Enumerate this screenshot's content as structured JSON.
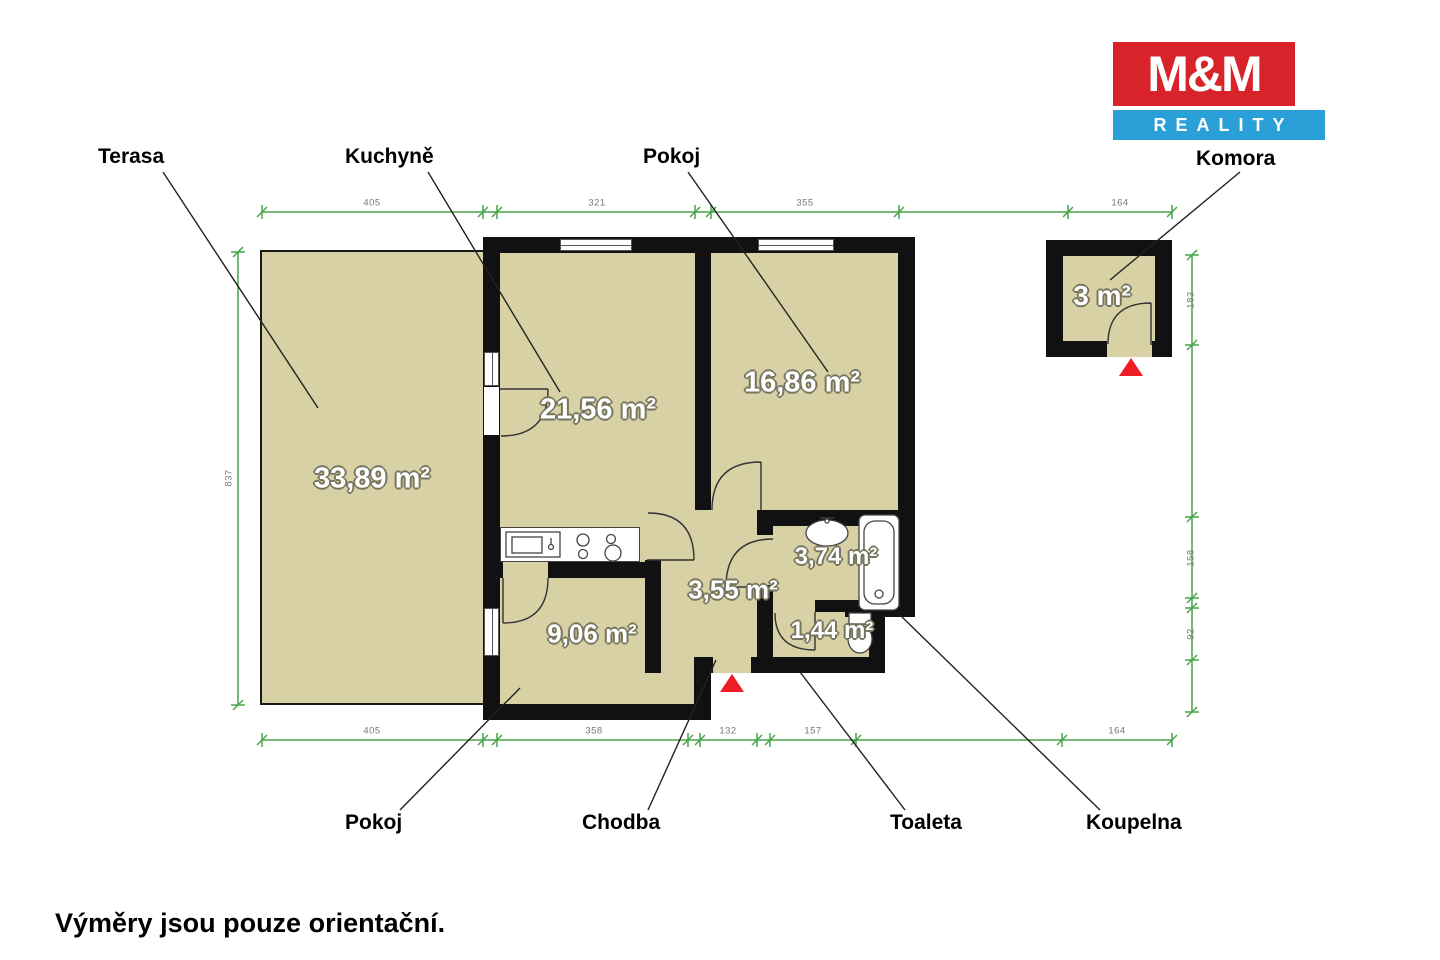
{
  "brand": {
    "line1": "M&M",
    "line2": "REALITY"
  },
  "callouts": {
    "terasa": "Terasa",
    "kuchyne": "Kuchyně",
    "pokoj_top": "Pokoj",
    "komora": "Komora",
    "pokoj_bottom": "Pokoj",
    "chodba": "Chodba",
    "toaleta": "Toaleta",
    "koupelna": "Koupelna"
  },
  "areas": {
    "terasa": "33,89 m²",
    "kuchyne": "21,56 m²",
    "pokoj_top": "16,86 m²",
    "komora": "3 m²",
    "pokoj_bottom": "9,06 m²",
    "chodba": "3,55 m²",
    "koupelna": "3,74 m²",
    "toaleta": "1,44 m²"
  },
  "dims": {
    "top": [
      "405",
      "321",
      "355",
      "164"
    ],
    "bottom": [
      "405",
      "358",
      "132",
      "157",
      "164"
    ],
    "left": [
      "837"
    ],
    "right": [
      "183",
      "158",
      "92"
    ]
  },
  "footer": {
    "note": "Výměry jsou pouze orientační."
  },
  "colors": {
    "floor": "#d8d1a6",
    "wall": "#111111",
    "dimension_green": "#4aa44a",
    "arrow_red": "#ee1c25",
    "logo_red": "#d8232a",
    "logo_blue": "#2b9fd8"
  }
}
